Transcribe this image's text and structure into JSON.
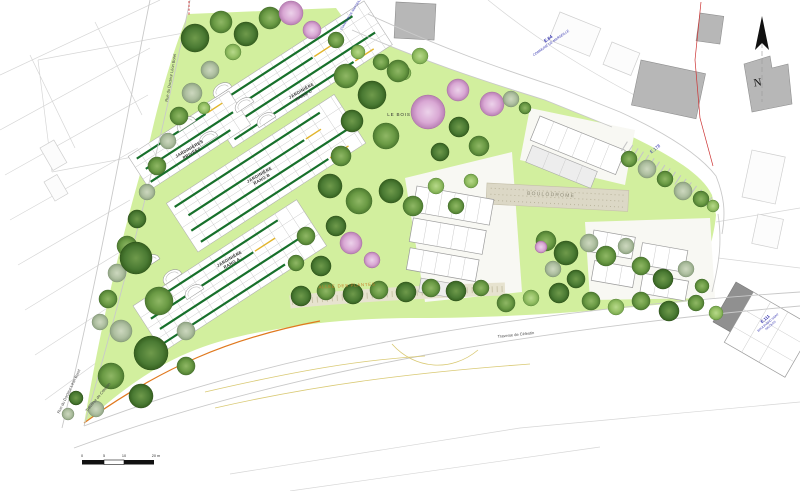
{
  "plan": {
    "plots": {
      "privees_line1": "JARDINIÈRES",
      "privees_line2": "PRIVÉES",
      "row_word": "JARDINIÈRE",
      "rang_c": "RANG C",
      "rang_b": "RANG B",
      "rang_a": "RANG A"
    },
    "areas": {
      "le_bois": "LE BOIS",
      "allee": "ALLÉE DES PLANTES",
      "boulodrome": "BOULODROME"
    },
    "streets": {
      "rue_docteur": "Rue du Docteur Léon Borel",
      "traverse": "Traverse de Célestin"
    },
    "cadastre": {
      "e64": "E.64",
      "e64_commune": "COMMUNE DE MARSEILLE",
      "e178": "E.178",
      "e111": "E.111",
      "e111_line2": "BOULEVARD SAINT",
      "e111_line3": "NICOLAS",
      "top_fragment": "COMMUNE DE MARSEILLE"
    },
    "compass": {
      "north": "N"
    },
    "scalebar": {
      "t0": "0",
      "t1": "5",
      "t2": "10",
      "t3": "20 m"
    },
    "colors": {
      "lawn": "#d2ef9e",
      "tree_dark": "#4a7a33",
      "tree_mid": "#6a9a44",
      "tree_pink": "#d9a8d4",
      "tree_sage": "#aebfa0",
      "stripe_green": "#17702b",
      "stripe_yellow": "#e2b52d",
      "cadastre_blue": "#2f2fae",
      "accent_orange": "#e0791f",
      "boundary_red": "#cc3333",
      "building_gray": "#b7b7b7"
    }
  }
}
